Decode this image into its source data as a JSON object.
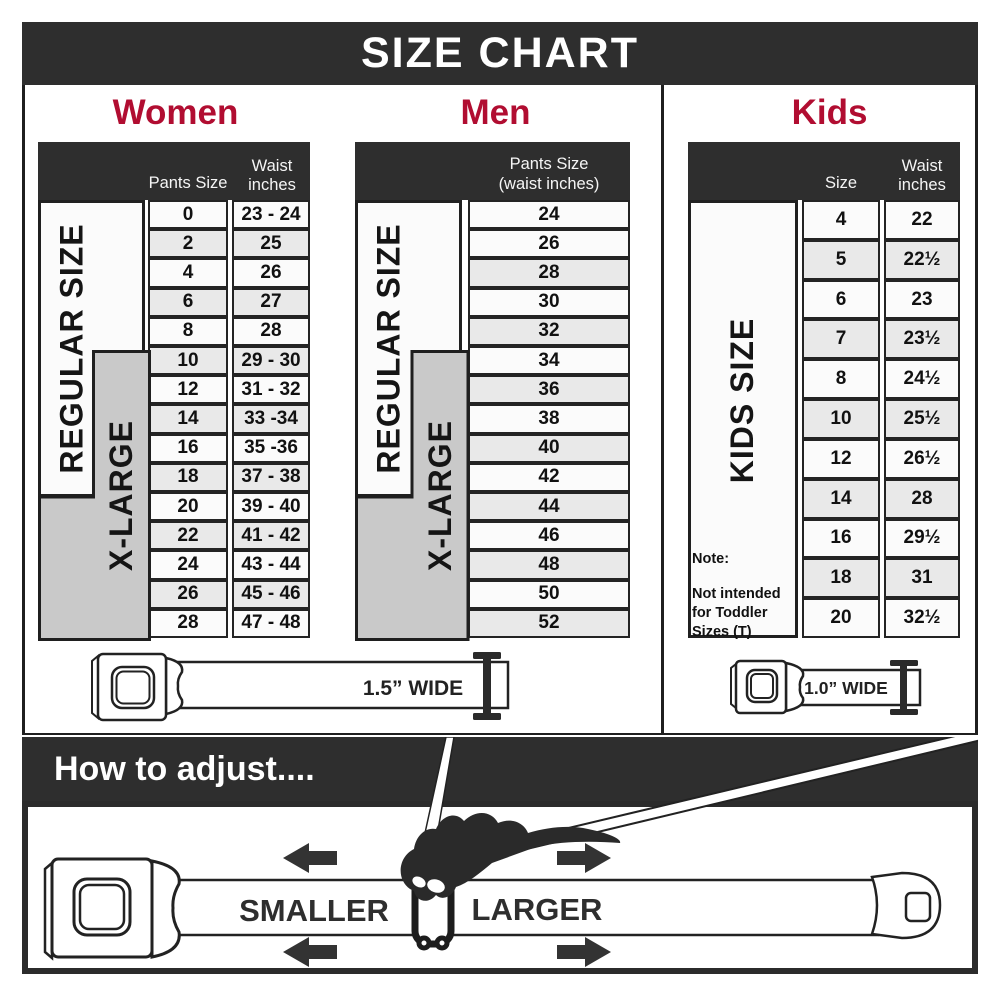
{
  "title": "SIZE CHART",
  "colors": {
    "dark_bar": "#2e2e2e",
    "heading_crimson": "#b10d31",
    "xlarge_gray": "#c9c9c9",
    "row_alt": "#e9e9e9"
  },
  "women": {
    "heading": "Women",
    "col1_header": "Pants Size",
    "col2_header_line1": "Waist",
    "col2_header_line2": "inches",
    "regular_label": "REGULAR SIZE",
    "xlarge_label": "X-LARGE",
    "rows": [
      {
        "size": "0",
        "waist": "23 - 24"
      },
      {
        "size": "2",
        "waist": "25"
      },
      {
        "size": "4",
        "waist": "26"
      },
      {
        "size": "6",
        "waist": "27"
      },
      {
        "size": "8",
        "waist": "28"
      },
      {
        "size": "10",
        "waist": "29 - 30"
      },
      {
        "size": "12",
        "waist": "31 - 32"
      },
      {
        "size": "14",
        "waist": "33 -34"
      },
      {
        "size": "16",
        "waist": "35 -36"
      },
      {
        "size": "18",
        "waist": "37 - 38"
      },
      {
        "size": "20",
        "waist": "39 - 40"
      },
      {
        "size": "22",
        "waist": "41 - 42"
      },
      {
        "size": "24",
        "waist": "43 - 44"
      },
      {
        "size": "26",
        "waist": "45 - 46"
      },
      {
        "size": "28",
        "waist": "47 - 48"
      }
    ]
  },
  "men": {
    "heading": "Men",
    "col_header_line1": "Pants Size",
    "col_header_line2": "(waist inches)",
    "regular_label": "REGULAR SIZE",
    "xlarge_label": "X-LARGE",
    "rows": [
      {
        "size": "24"
      },
      {
        "size": "26"
      },
      {
        "size": "28"
      },
      {
        "size": "30"
      },
      {
        "size": "32"
      },
      {
        "size": "34"
      },
      {
        "size": "36"
      },
      {
        "size": "38"
      },
      {
        "size": "40"
      },
      {
        "size": "42"
      },
      {
        "size": "44"
      },
      {
        "size": "46"
      },
      {
        "size": "48"
      },
      {
        "size": "50"
      },
      {
        "size": "52"
      }
    ]
  },
  "kids": {
    "heading": "Kids",
    "col1_header": "Size",
    "col2_header_line1": "Waist",
    "col2_header_line2": "inches",
    "side_label": "KIDS SIZE",
    "note_line1": "Note:",
    "note_line2": "Not intended for",
    "note_line3": "Toddler Sizes (T)",
    "rows": [
      {
        "size": "4",
        "waist": "22"
      },
      {
        "size": "5",
        "waist": "22½"
      },
      {
        "size": "6",
        "waist": "23"
      },
      {
        "size": "7",
        "waist": "23½"
      },
      {
        "size": "8",
        "waist": "24½"
      },
      {
        "size": "10",
        "waist": "25½"
      },
      {
        "size": "12",
        "waist": "26½"
      },
      {
        "size": "14",
        "waist": "28"
      },
      {
        "size": "16",
        "waist": "29½"
      },
      {
        "size": "18",
        "waist": "31"
      },
      {
        "size": "20",
        "waist": "32½"
      }
    ]
  },
  "belts": {
    "adult_width_label": "1.5” WIDE",
    "kids_width_label": "1.0” WIDE"
  },
  "how_to": {
    "heading": "How to adjust....",
    "smaller_label": "SMALLER",
    "larger_label": "LARGER"
  }
}
